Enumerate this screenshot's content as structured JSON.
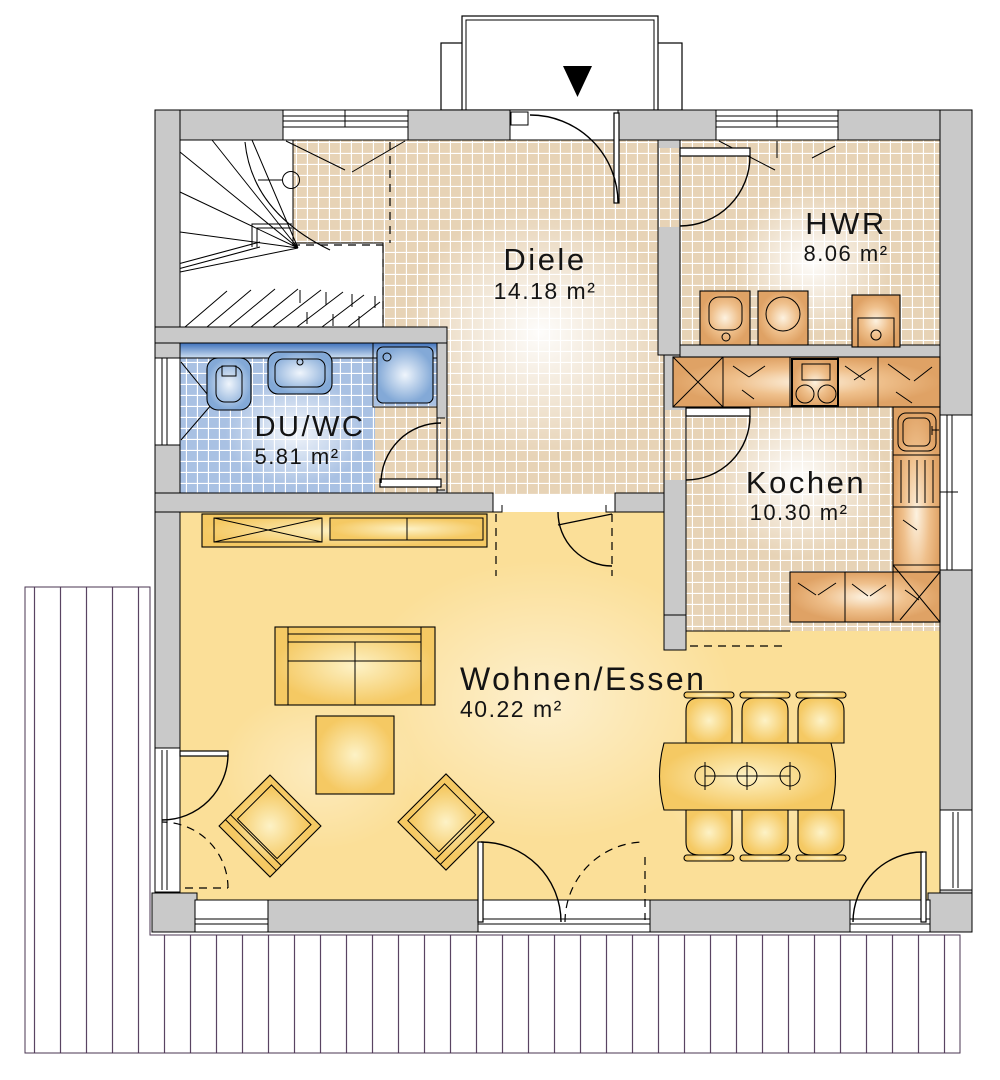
{
  "plan": {
    "type": "floorplan",
    "floor_rooms": [
      {
        "id": "diele",
        "name": "Diele",
        "area": "14.18 m²"
      },
      {
        "id": "hwr",
        "name": "HWR",
        "area": "8.06 m²"
      },
      {
        "id": "duwc",
        "name": "DU/WC",
        "area": "5.81 m²"
      },
      {
        "id": "kochen",
        "name": "Kochen",
        "area": "10.30 m²"
      },
      {
        "id": "wohnen",
        "name": "Wohnen/Essen",
        "area": "40.22 m²"
      }
    ],
    "icons": {
      "entrance_arrow": "filled-triangle-down"
    },
    "colors": {
      "wall_gray": "#c9c9c9",
      "tile_beige": "#e7d3b6",
      "tile_blue": "#a9c1e3",
      "floor_yellow": "#fbdf98",
      "furniture_tan": "#e2a86f",
      "furniture_yellow": "#f5c963",
      "fixture_blue": "#86abd8",
      "terrace_line": "#5a4462",
      "outline": "#000000"
    }
  }
}
